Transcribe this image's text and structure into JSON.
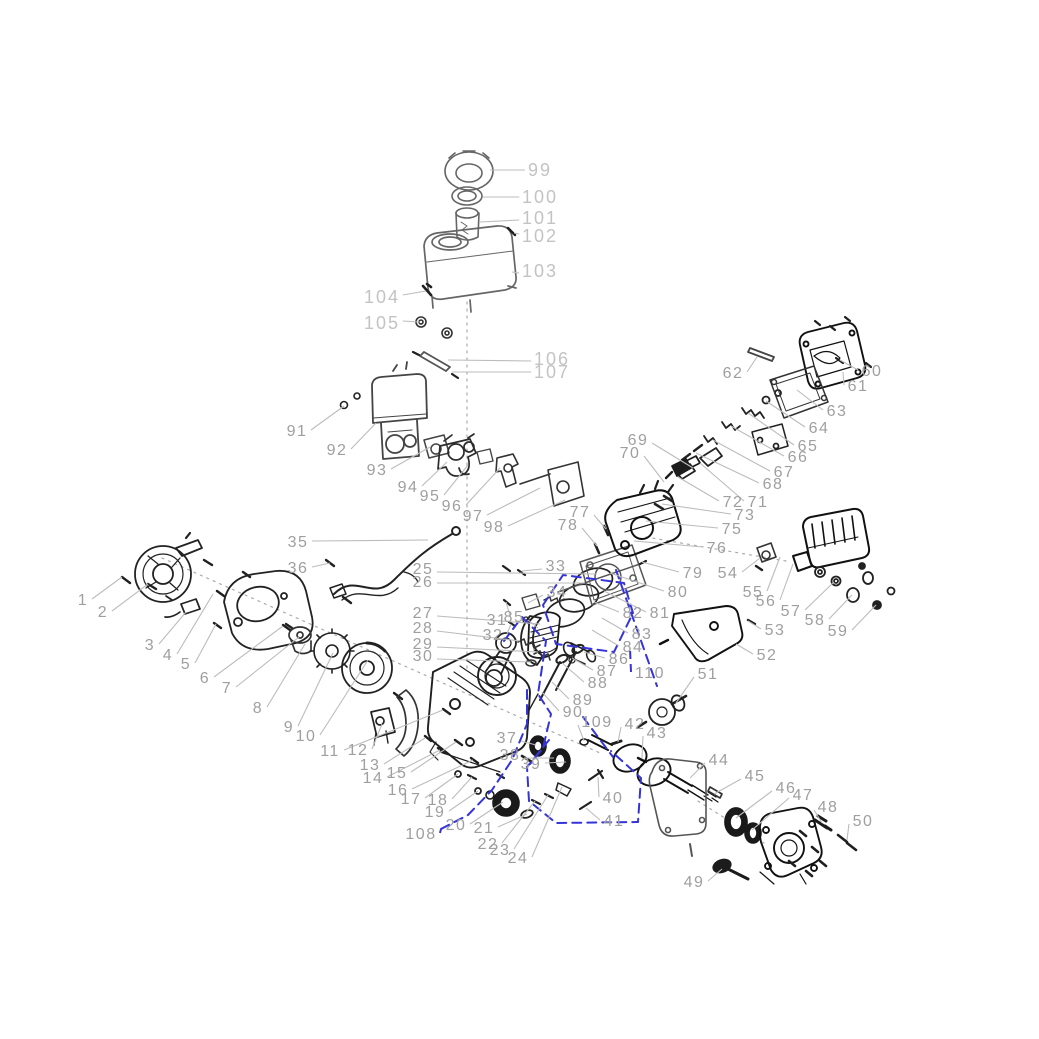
{
  "figure": {
    "width": 1039,
    "height": 1039,
    "background": "#ffffff"
  },
  "colors": {
    "label": "#9f9f9f",
    "label_light": "#c3c3c3",
    "leader": "#bcbcbc",
    "line_dark": "#1f1f1f",
    "line_mid": "#4a4a4a",
    "line_light": "#777777",
    "highlight": "#3434d8"
  },
  "callouts": {
    "items": [
      {
        "t": "99",
        "x": 540,
        "y": 170,
        "tx": 490,
        "ty": 170,
        "cls": "light"
      },
      {
        "t": "100",
        "x": 540,
        "y": 197,
        "tx": 483,
        "ty": 197,
        "cls": "light"
      },
      {
        "t": "101",
        "x": 540,
        "y": 218,
        "tx": 480,
        "ty": 222,
        "cls": "light"
      },
      {
        "t": "102",
        "x": 540,
        "y": 236,
        "tx": 514,
        "ty": 233,
        "cls": "light"
      },
      {
        "t": "103",
        "x": 540,
        "y": 271,
        "tx": 512,
        "ty": 272,
        "cls": "light"
      },
      {
        "t": "104",
        "x": 382,
        "y": 297,
        "tx": 426,
        "ty": 291,
        "cls": "light"
      },
      {
        "t": "105",
        "x": 382,
        "y": 323,
        "tx": 420,
        "ty": 322,
        "cls": "light"
      },
      {
        "t": "106",
        "x": 552,
        "y": 359,
        "tx": 448,
        "ty": 360,
        "cls": "light"
      },
      {
        "t": "107",
        "x": 552,
        "y": 372,
        "tx": 452,
        "ty": 372,
        "cls": "light"
      },
      {
        "t": "1",
        "x": 83,
        "y": 601,
        "tx": 122,
        "ty": 577
      },
      {
        "t": "2",
        "x": 103,
        "y": 613,
        "tx": 148,
        "ty": 584
      },
      {
        "t": "3",
        "x": 150,
        "y": 646,
        "tx": 186,
        "ty": 612
      },
      {
        "t": "4",
        "x": 168,
        "y": 656,
        "tx": 213,
        "ty": 594
      },
      {
        "t": "5",
        "x": 186,
        "y": 665,
        "tx": 216,
        "ty": 624
      },
      {
        "t": "6",
        "x": 205,
        "y": 679,
        "tx": 283,
        "ty": 626
      },
      {
        "t": "7",
        "x": 227,
        "y": 689,
        "tx": 299,
        "ty": 637
      },
      {
        "t": "8",
        "x": 258,
        "y": 709,
        "tx": 305,
        "ty": 644
      },
      {
        "t": "9",
        "x": 289,
        "y": 728,
        "tx": 333,
        "ty": 653
      },
      {
        "t": "10",
        "x": 306,
        "y": 737,
        "tx": 368,
        "ty": 660
      },
      {
        "t": "11",
        "x": 330,
        "y": 752,
        "tx": 443,
        "ty": 710
      },
      {
        "t": "12",
        "x": 358,
        "y": 751,
        "tx": 382,
        "ty": 724
      },
      {
        "t": "13",
        "x": 370,
        "y": 766,
        "tx": 425,
        "ty": 738
      },
      {
        "t": "14",
        "x": 373,
        "y": 779,
        "tx": 440,
        "ty": 750
      },
      {
        "t": "15",
        "x": 397,
        "y": 774,
        "tx": 456,
        "ty": 742
      },
      {
        "t": "16",
        "x": 398,
        "y": 791,
        "tx": 473,
        "ty": 760
      },
      {
        "t": "17",
        "x": 411,
        "y": 800,
        "tx": 458,
        "ty": 774
      },
      {
        "t": "18",
        "x": 438,
        "y": 801,
        "tx": 472,
        "ty": 777
      },
      {
        "t": "19",
        "x": 435,
        "y": 813,
        "tx": 478,
        "ty": 791
      },
      {
        "t": "20",
        "x": 456,
        "y": 826,
        "tx": 503,
        "ty": 802
      },
      {
        "t": "21",
        "x": 484,
        "y": 829,
        "tx": 527,
        "ty": 814
      },
      {
        "t": "22",
        "x": 488,
        "y": 845,
        "tx": 535,
        "ty": 801
      },
      {
        "t": "23",
        "x": 500,
        "y": 851,
        "tx": 548,
        "ty": 795
      },
      {
        "t": "24",
        "x": 518,
        "y": 859,
        "tx": 562,
        "ty": 787
      },
      {
        "t": "108",
        "x": 421,
        "y": 835,
        "tx": 441,
        "ty": 829,
        "blue": true
      },
      {
        "t": "25",
        "x": 423,
        "y": 570,
        "tx": 597,
        "ty": 574
      },
      {
        "t": "26",
        "x": 423,
        "y": 583,
        "tx": 585,
        "ty": 583
      },
      {
        "t": "27",
        "x": 423,
        "y": 614,
        "tx": 540,
        "ty": 624
      },
      {
        "t": "28",
        "x": 423,
        "y": 629,
        "tx": 520,
        "ty": 641
      },
      {
        "t": "29",
        "x": 423,
        "y": 645,
        "tx": 538,
        "ty": 652
      },
      {
        "t": "30",
        "x": 423,
        "y": 657,
        "tx": 531,
        "ty": 662
      },
      {
        "t": "31",
        "x": 497,
        "y": 621,
        "tx": 506,
        "ty": 602
      },
      {
        "t": "32",
        "x": 493,
        "y": 636,
        "tx": 511,
        "ty": 624
      },
      {
        "t": "33",
        "x": 556,
        "y": 567,
        "tx": 522,
        "ty": 571
      },
      {
        "t": "34",
        "x": 557,
        "y": 593,
        "tx": 528,
        "ty": 603
      },
      {
        "t": "35",
        "x": 298,
        "y": 543,
        "tx": 428,
        "ty": 540
      },
      {
        "t": "36",
        "x": 298,
        "y": 569,
        "tx": 330,
        "ty": 563
      },
      {
        "t": "37",
        "x": 507,
        "y": 739,
        "tx": 536,
        "ty": 745
      },
      {
        "t": "38",
        "x": 510,
        "y": 756,
        "tx": 554,
        "ty": 758
      },
      {
        "t": "39",
        "x": 531,
        "y": 765,
        "tx": 566,
        "ty": 762
      },
      {
        "t": "40",
        "x": 613,
        "y": 799,
        "tx": 598,
        "ty": 777
      },
      {
        "t": "41",
        "x": 614,
        "y": 822,
        "tx": 586,
        "ty": 808
      },
      {
        "t": "42",
        "x": 635,
        "y": 725,
        "tx": 618,
        "ty": 742
      },
      {
        "t": "43",
        "x": 657,
        "y": 734,
        "tx": 642,
        "ty": 758
      },
      {
        "t": "109",
        "x": 597,
        "y": 723,
        "tx": 584,
        "ty": 741
      },
      {
        "t": "110",
        "x": 650,
        "y": 674,
        "tx": 630,
        "ty": 648,
        "blue": true
      },
      {
        "t": "44",
        "x": 719,
        "y": 761,
        "tx": 690,
        "ty": 778
      },
      {
        "t": "45",
        "x": 755,
        "y": 777,
        "tx": 714,
        "ty": 794
      },
      {
        "t": "46",
        "x": 786,
        "y": 789,
        "tx": 736,
        "ty": 818
      },
      {
        "t": "47",
        "x": 803,
        "y": 796,
        "tx": 752,
        "ty": 830
      },
      {
        "t": "48",
        "x": 828,
        "y": 808,
        "tx": 822,
        "ty": 823
      },
      {
        "t": "49",
        "x": 694,
        "y": 883,
        "tx": 722,
        "ty": 869
      },
      {
        "t": "50",
        "x": 863,
        "y": 822,
        "tx": 847,
        "ty": 840
      },
      {
        "t": "51",
        "x": 708,
        "y": 675,
        "tx": 676,
        "ty": 703
      },
      {
        "t": "52",
        "x": 767,
        "y": 656,
        "tx": 736,
        "ty": 644
      },
      {
        "t": "53",
        "x": 775,
        "y": 631,
        "tx": 748,
        "ty": 621
      },
      {
        "t": "54",
        "x": 728,
        "y": 574,
        "tx": 760,
        "ty": 558
      },
      {
        "t": "55",
        "x": 753,
        "y": 593,
        "tx": 780,
        "ty": 557
      },
      {
        "t": "56",
        "x": 766,
        "y": 602,
        "tx": 793,
        "ty": 564
      },
      {
        "t": "57",
        "x": 791,
        "y": 612,
        "tx": 834,
        "ty": 582
      },
      {
        "t": "58",
        "x": 815,
        "y": 621,
        "tx": 852,
        "ty": 595
      },
      {
        "t": "59",
        "x": 838,
        "y": 632,
        "tx": 876,
        "ty": 605
      },
      {
        "t": "60",
        "x": 872,
        "y": 372,
        "tx": 840,
        "ty": 360
      },
      {
        "t": "61",
        "x": 858,
        "y": 387,
        "tx": 843,
        "ty": 372
      },
      {
        "t": "62",
        "x": 733,
        "y": 374,
        "tx": 757,
        "ty": 357
      },
      {
        "t": "63",
        "x": 837,
        "y": 412,
        "tx": 797,
        "ty": 390
      },
      {
        "t": "64",
        "x": 819,
        "y": 429,
        "tx": 766,
        "ty": 401
      },
      {
        "t": "65",
        "x": 808,
        "y": 447,
        "tx": 748,
        "ty": 413
      },
      {
        "t": "66",
        "x": 798,
        "y": 458,
        "tx": 731,
        "ty": 426
      },
      {
        "t": "67",
        "x": 784,
        "y": 473,
        "tx": 713,
        "ty": 440
      },
      {
        "t": "68",
        "x": 773,
        "y": 485,
        "tx": 696,
        "ty": 453
      },
      {
        "t": "69",
        "x": 638,
        "y": 441,
        "tx": 693,
        "ty": 468
      },
      {
        "t": "70",
        "x": 630,
        "y": 454,
        "tx": 664,
        "ty": 482
      },
      {
        "t": "71",
        "x": 758,
        "y": 503,
        "tx": 700,
        "ty": 463
      },
      {
        "t": "72",
        "x": 733,
        "y": 503,
        "tx": 678,
        "ty": 477
      },
      {
        "t": "73",
        "x": 745,
        "y": 516,
        "tx": 662,
        "ty": 504
      },
      {
        "t": "75",
        "x": 732,
        "y": 530,
        "tx": 646,
        "ty": 521
      },
      {
        "t": "76",
        "x": 717,
        "y": 549,
        "tx": 634,
        "ty": 541
      },
      {
        "t": "77",
        "x": 580,
        "y": 513,
        "tx": 606,
        "ty": 529
      },
      {
        "t": "78",
        "x": 568,
        "y": 526,
        "tx": 597,
        "ty": 546
      },
      {
        "t": "79",
        "x": 693,
        "y": 574,
        "tx": 642,
        "ty": 562
      },
      {
        "t": "80",
        "x": 678,
        "y": 593,
        "tx": 610,
        "ty": 573
      },
      {
        "t": "81",
        "x": 660,
        "y": 614,
        "tx": 604,
        "ty": 591
      },
      {
        "t": "82",
        "x": 633,
        "y": 614,
        "tx": 594,
        "ty": 602
      },
      {
        "t": "83",
        "x": 642,
        "y": 635,
        "tx": 602,
        "ty": 618
      },
      {
        "t": "84",
        "x": 633,
        "y": 648,
        "tx": 592,
        "ty": 630
      },
      {
        "t": "85",
        "x": 514,
        "y": 618,
        "tx": 538,
        "ty": 628
      },
      {
        "t": "86",
        "x": 619,
        "y": 660,
        "tx": 584,
        "ty": 652
      },
      {
        "t": "87",
        "x": 607,
        "y": 672,
        "tx": 572,
        "ty": 658
      },
      {
        "t": "88",
        "x": 598,
        "y": 684,
        "tx": 562,
        "ty": 663
      },
      {
        "t": "89",
        "x": 583,
        "y": 701,
        "tx": 552,
        "ty": 682
      },
      {
        "t": "90",
        "x": 573,
        "y": 713,
        "tx": 542,
        "ty": 692
      },
      {
        "t": "91",
        "x": 297,
        "y": 432,
        "tx": 344,
        "ty": 406
      },
      {
        "t": "92",
        "x": 337,
        "y": 451,
        "tx": 376,
        "ty": 423
      },
      {
        "t": "93",
        "x": 377,
        "y": 471,
        "tx": 430,
        "ty": 447
      },
      {
        "t": "94",
        "x": 408,
        "y": 488,
        "tx": 447,
        "ty": 462
      },
      {
        "t": "95",
        "x": 430,
        "y": 497,
        "tx": 468,
        "ty": 465
      },
      {
        "t": "96",
        "x": 452,
        "y": 507,
        "tx": 500,
        "ty": 468
      },
      {
        "t": "97",
        "x": 473,
        "y": 517,
        "tx": 540,
        "ty": 488
      },
      {
        "t": "98",
        "x": 494,
        "y": 528,
        "tx": 565,
        "ty": 500
      }
    ]
  }
}
